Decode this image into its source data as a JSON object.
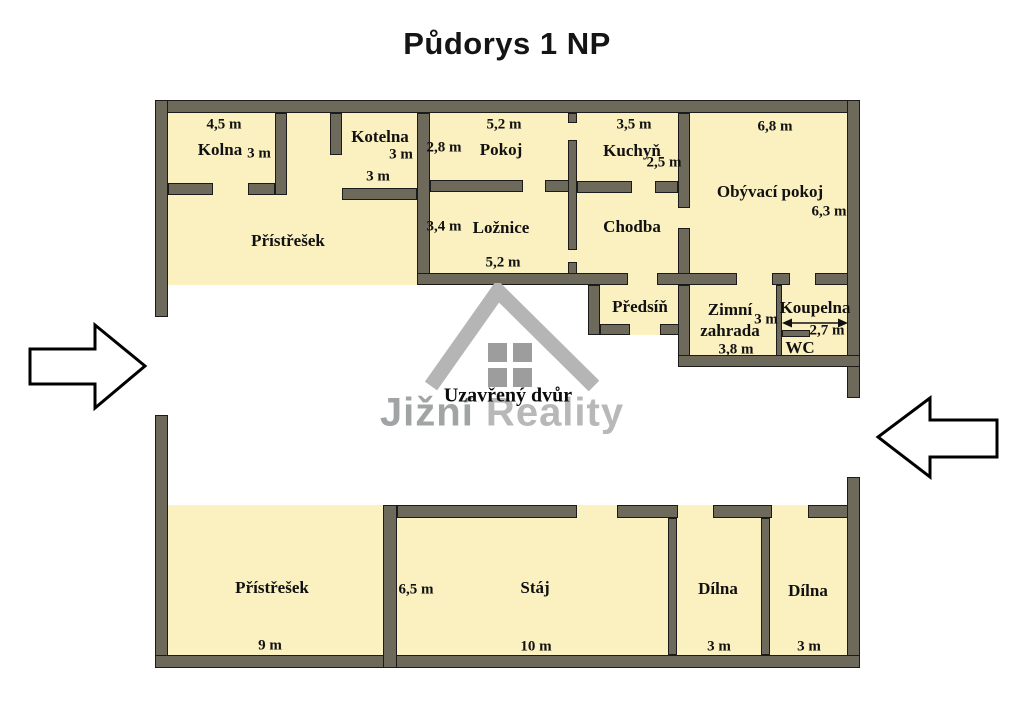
{
  "title": "Půdorys 1 NP",
  "courtyard": {
    "label": "Uzavřený dvůr"
  },
  "watermark": {
    "word1": "Jižní",
    "word2": "Reality"
  },
  "colors": {
    "room_fill": "#FAF0C0",
    "wall_fill": "#6E6A5B",
    "wall_outline": "#1B1B1B",
    "logo_gray": "#B5B5B5",
    "pane_gray": "#9D9D9D"
  },
  "rooms": {
    "kolna": {
      "label": "Kolna",
      "dim_top": "4,5 m",
      "dim_side": "3 m"
    },
    "kotelna": {
      "label": "Kotelna",
      "dim_side": "3 m",
      "dim_bottom": "3 m"
    },
    "pristresek_top": {
      "label": "Přístřešek"
    },
    "pokoj": {
      "label": "Pokoj",
      "dim_top": "5,2 m",
      "dim_side": "2,8 m"
    },
    "loznice": {
      "label": "Ložnice",
      "dim_side": "3,4 m",
      "dim_bottom": "5,2 m"
    },
    "kuchyn": {
      "label": "Kuchyň",
      "dim_top": "3,5 m",
      "dim_side": "2,5 m"
    },
    "chodba": {
      "label": "Chodba"
    },
    "obyvaci_pokoj": {
      "label": "Obývací pokoj",
      "dim_top": "6,8 m",
      "dim_side": "6,3 m"
    },
    "predsin": {
      "label": "Předsíň"
    },
    "zimni_zahrada": {
      "label": "Zimní zahrada",
      "dim_side": "3 m",
      "dim_bottom": "3,8 m"
    },
    "koupelna": {
      "label": "Koupelna",
      "dim_width": "2,7 m"
    },
    "wc": {
      "label": "WC"
    },
    "pristresek_bottom": {
      "label": "Přístřešek",
      "dim_bottom": "9 m"
    },
    "staj": {
      "label": "Stáj",
      "dim_side": "6,5 m",
      "dim_bottom": "10 m"
    },
    "dilna_1": {
      "label": "Dílna",
      "dim_bottom": "3 m"
    },
    "dilna_2": {
      "label": "Dílna",
      "dim_bottom": "3 m"
    }
  }
}
